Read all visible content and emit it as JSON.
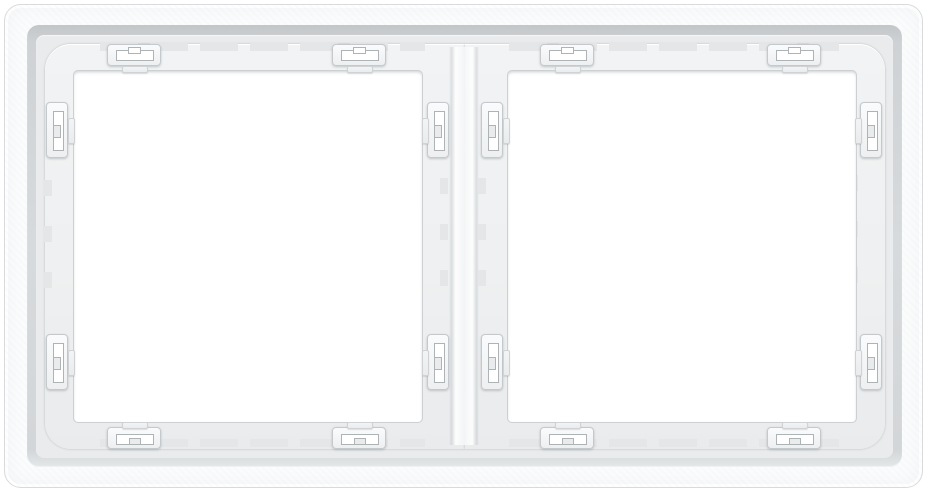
{
  "scene": {
    "subject": "white two-gang wall switch mounting frame, rear view",
    "openings": 2,
    "clips_per_opening": 8
  },
  "colors": {
    "page-bg": "#ffffff",
    "frame-face": "#fbfcfd",
    "frame-outline": "#d8dbdd",
    "bevel-dark": "#c3c6c8",
    "plate-col": "#e9ebec",
    "surround-col": "#eef0f1",
    "opening-col": "#ffffff",
    "rim-col": "#ccd0d3",
    "notch-col": "#e4e6e8",
    "clip-border": "#c5c9cc",
    "slot-col": "#ffffff",
    "slot-border": "#aeb3b6"
  }
}
